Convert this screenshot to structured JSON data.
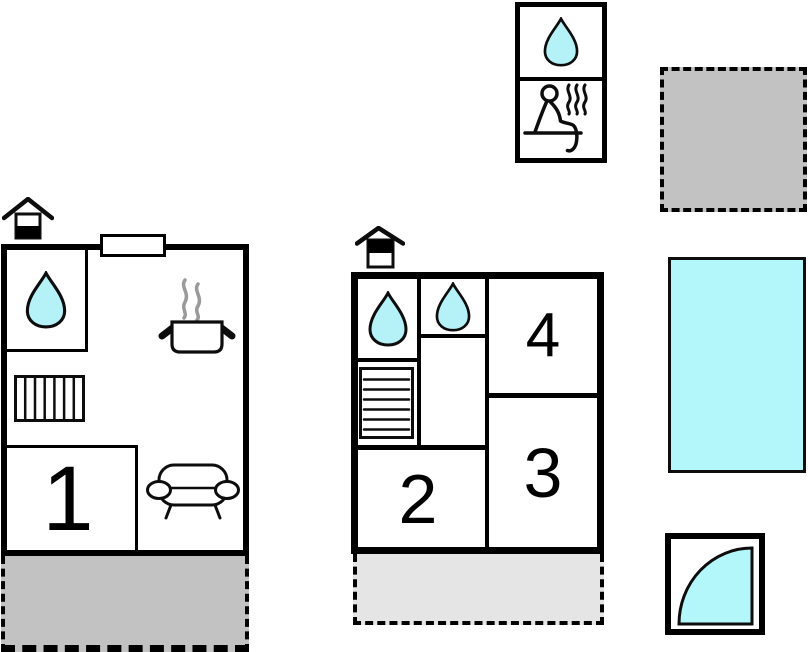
{
  "colors": {
    "wall": "#000000",
    "water": "#b4f2f7",
    "pool": "#b4f7fa",
    "terrace_dark": "#c2c2c2",
    "terrace_light": "#e5e5e5",
    "steam": "#9a9a9a"
  },
  "legend_box": {
    "icons": [
      {
        "name": "water-drop-icon",
        "meaning": "bathroom"
      },
      {
        "name": "sauna-icon",
        "meaning": "sauna"
      }
    ]
  },
  "house_main": {
    "rooms": [
      {
        "label": "1"
      }
    ],
    "icons": [
      "chimney-icon",
      "water-drop-icon",
      "wardrobe-icon",
      "stove-icon",
      "sofa-icon"
    ]
  },
  "house_annex": {
    "rooms": [
      {
        "label": "2"
      },
      {
        "label": "3"
      },
      {
        "label": "4"
      }
    ],
    "icons": [
      "chimney-icon",
      "water-drop-icon",
      "water-drop-icon",
      "stairs-icon"
    ]
  },
  "outdoor": {
    "features": [
      "plot-area",
      "swimming-pool",
      "outdoor-hot-tub",
      "terrace",
      "terrace"
    ]
  }
}
